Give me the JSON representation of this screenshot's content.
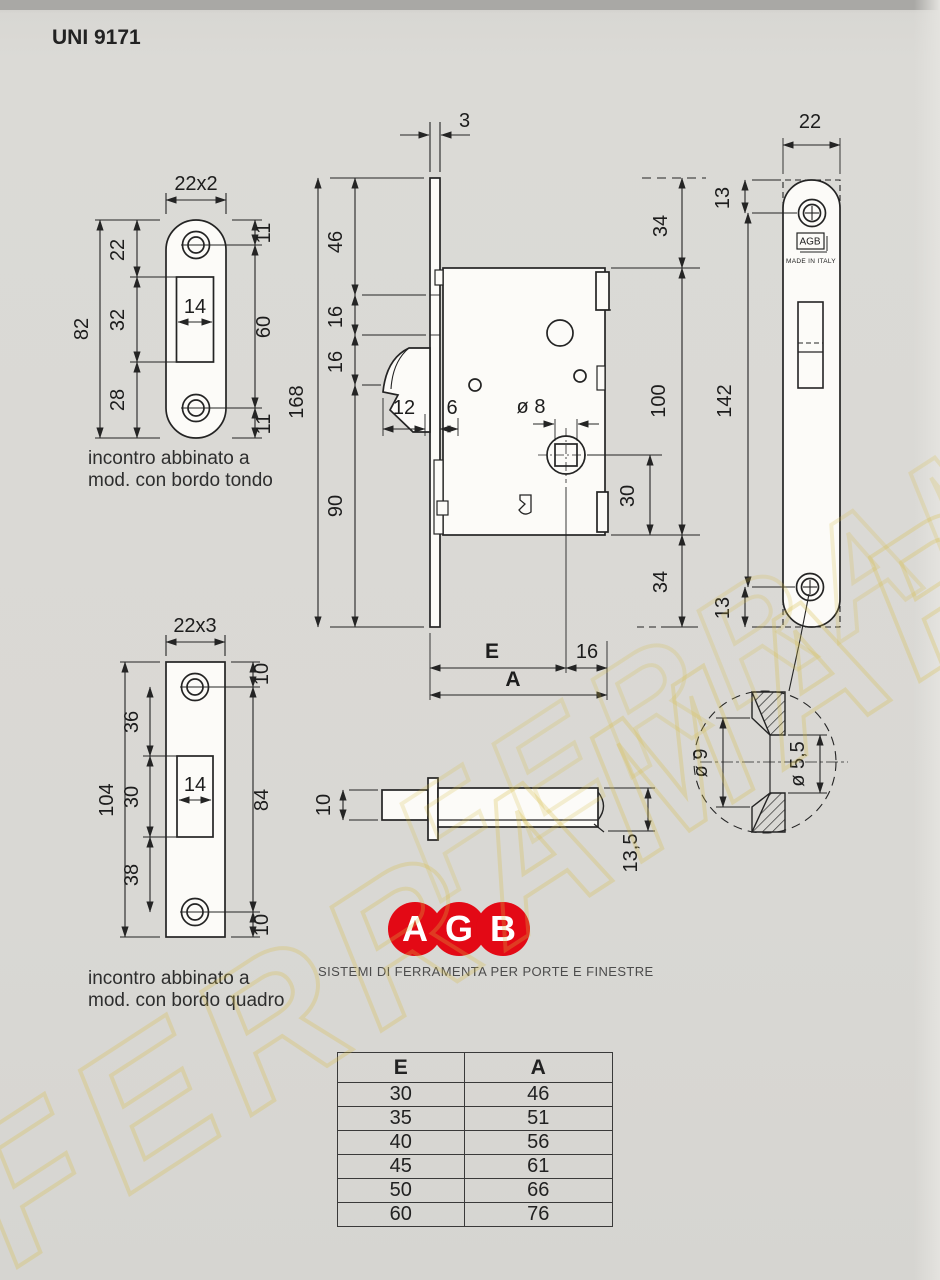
{
  "title": "UNI 9171",
  "watermark": "FERRAMAR",
  "colors": {
    "paper": "#d9d8d4",
    "ink": "#242424",
    "brand_red": "#e30915",
    "watermark": "#d8be46"
  },
  "tl_plate": {
    "size": "22x2",
    "height": "82",
    "seg_top": "22",
    "seg_mid": "32",
    "seg_bot": "28",
    "edge_top": "11",
    "screws": "60",
    "edge_bot": "11",
    "slot_w": "14",
    "caption1": "incontro abbinato a",
    "caption2": "mod. con bordo tondo"
  },
  "bl_plate": {
    "size": "22x3",
    "height": "104",
    "seg_top": "36",
    "seg_mid": "30",
    "seg_bot": "38",
    "edge_top": "10",
    "screws": "84",
    "edge_bot": "10",
    "slot_w": "14",
    "caption1": "incontro abbinato a",
    "caption2": "mod. con bordo quadro"
  },
  "lock": {
    "face_thickness": "3",
    "seg_46": "46",
    "seg_16a": "16",
    "seg_16b": "16",
    "total": "168",
    "lower": "90",
    "hook_depth": "12",
    "gap": "6",
    "spindle_dia": "ø 8",
    "top_34": "34",
    "body_100": "100",
    "spindle_30": "30",
    "bottom_34": "34",
    "backset": "E",
    "to_edge": "16",
    "overall": "A"
  },
  "front_plate": {
    "width": "22",
    "edge_top": "13",
    "screw_span": "142",
    "edge_bot": "13",
    "brand": "AGB",
    "made_in": "MADE IN ITALY"
  },
  "detail": {
    "outer_dia": "ø 9",
    "inner_dia": "ø 5,5"
  },
  "pin": {
    "height": "10",
    "depth": "13,5"
  },
  "logo": {
    "l1": "A",
    "l2": "G",
    "l3": "B",
    "tagline": "SISTEMI DI FERRAMENTA PER PORTE E FINESTRE"
  },
  "table": {
    "headers": [
      "E",
      "A"
    ],
    "rows": [
      [
        "30",
        "46"
      ],
      [
        "35",
        "51"
      ],
      [
        "40",
        "56"
      ],
      [
        "45",
        "61"
      ],
      [
        "50",
        "66"
      ],
      [
        "60",
        "76"
      ]
    ]
  }
}
